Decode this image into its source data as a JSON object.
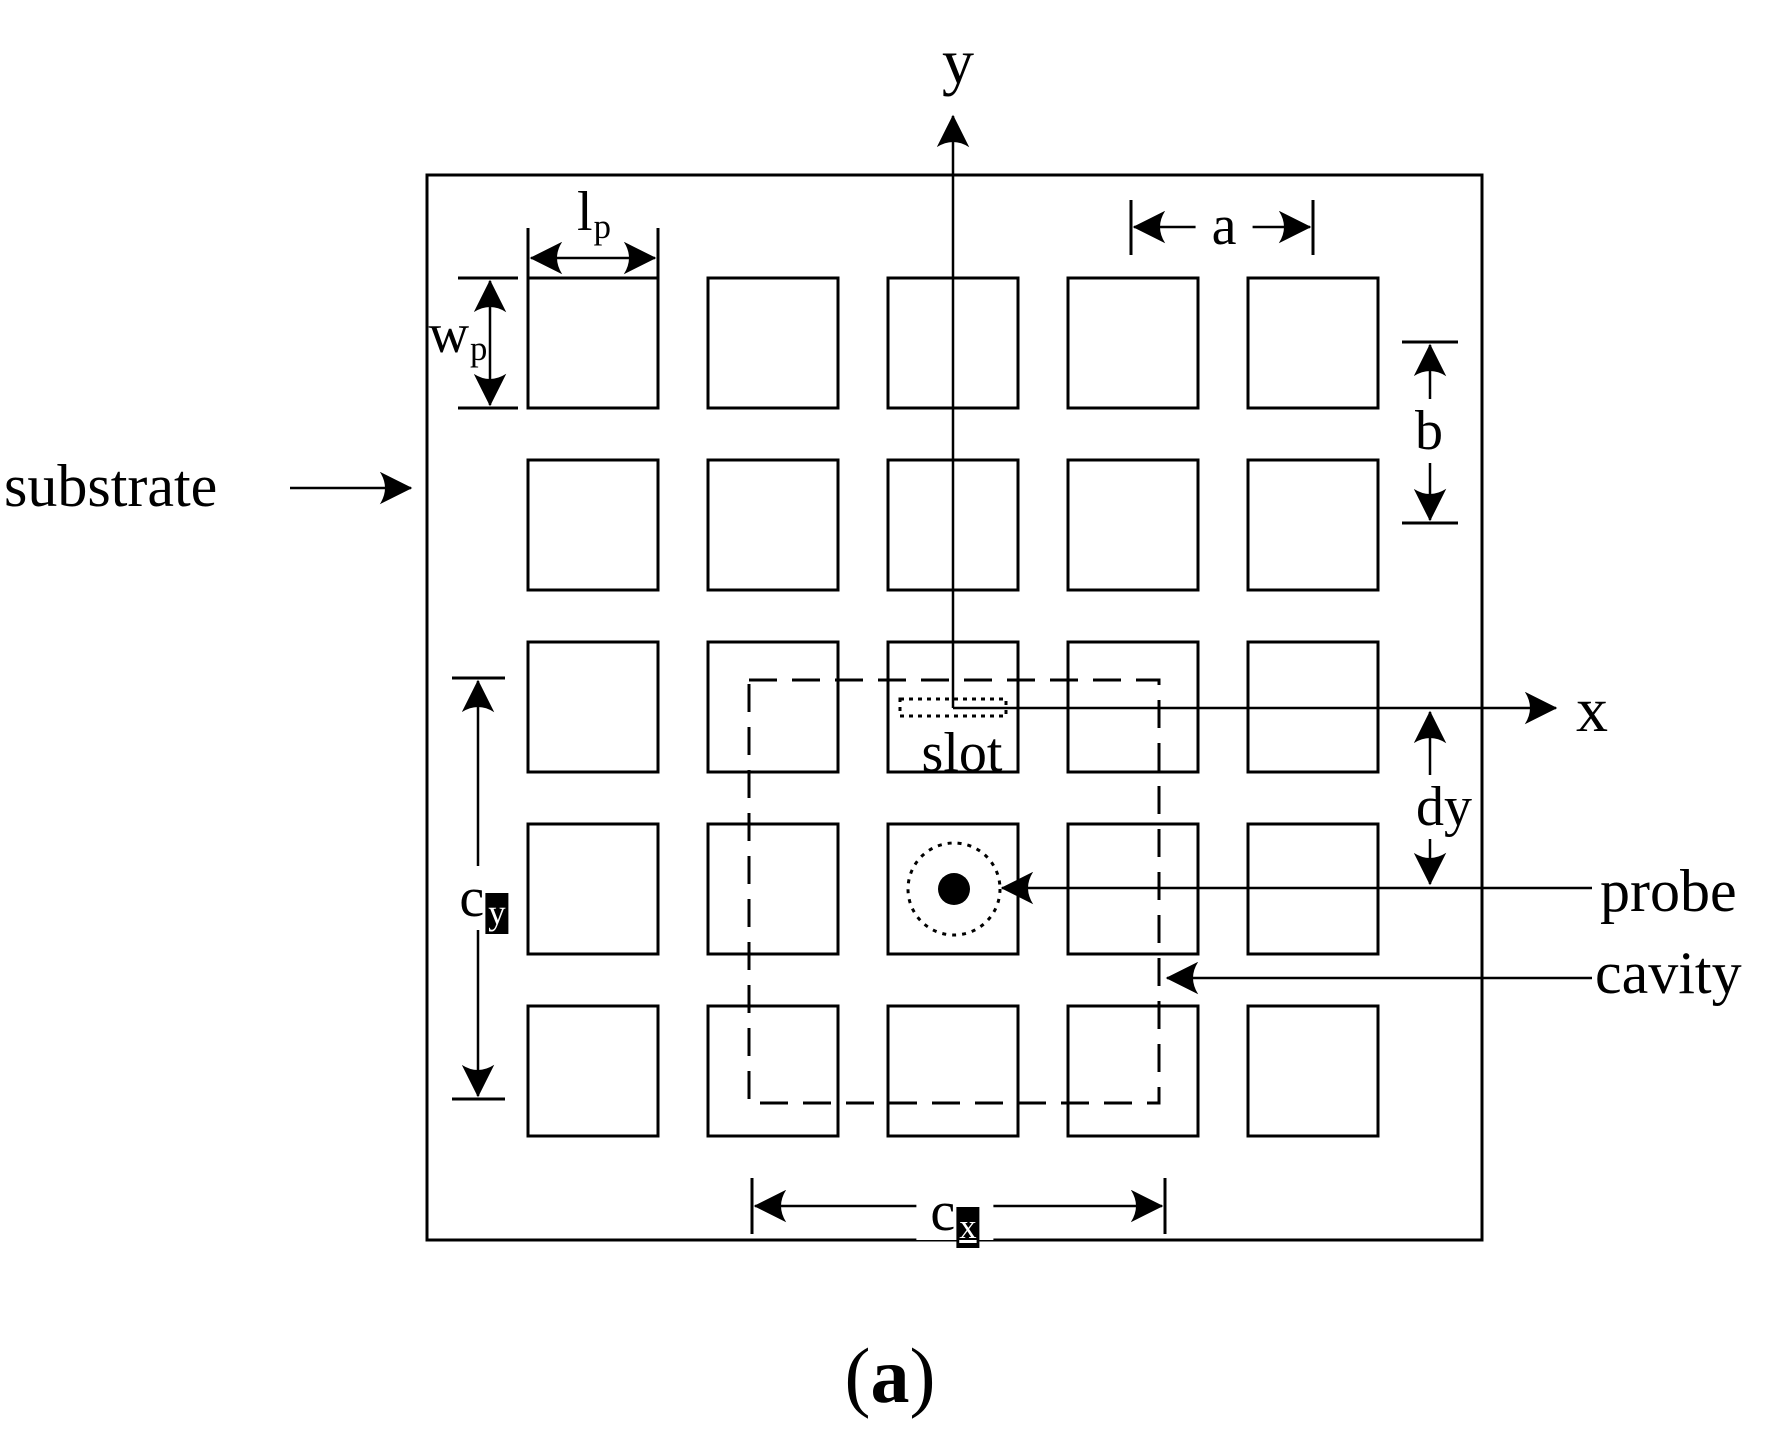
{
  "figure": {
    "caption": {
      "open": "(",
      "letter": "a",
      "close": ")"
    },
    "axis_labels": {
      "x": "x",
      "y": "y"
    },
    "labels": {
      "substrate": "substrate",
      "slot": "slot",
      "probe": "probe",
      "cavity": "cavity"
    },
    "dimension_labels": {
      "patch_length": {
        "main": "l",
        "sub": "p"
      },
      "patch_width": {
        "main": "w",
        "sub": "p"
      },
      "cell_spacing_x": "a",
      "cell_spacing_y": "b",
      "cavity_size_x": {
        "main": "c",
        "sub": "x"
      },
      "cavity_size_y": {
        "main": "c",
        "sub": "y"
      },
      "probe_offset_y": "dy"
    },
    "grid": {
      "rows": 5,
      "cols": 5
    },
    "colors": {
      "ink": "#000000",
      "paper": "#ffffff"
    }
  }
}
